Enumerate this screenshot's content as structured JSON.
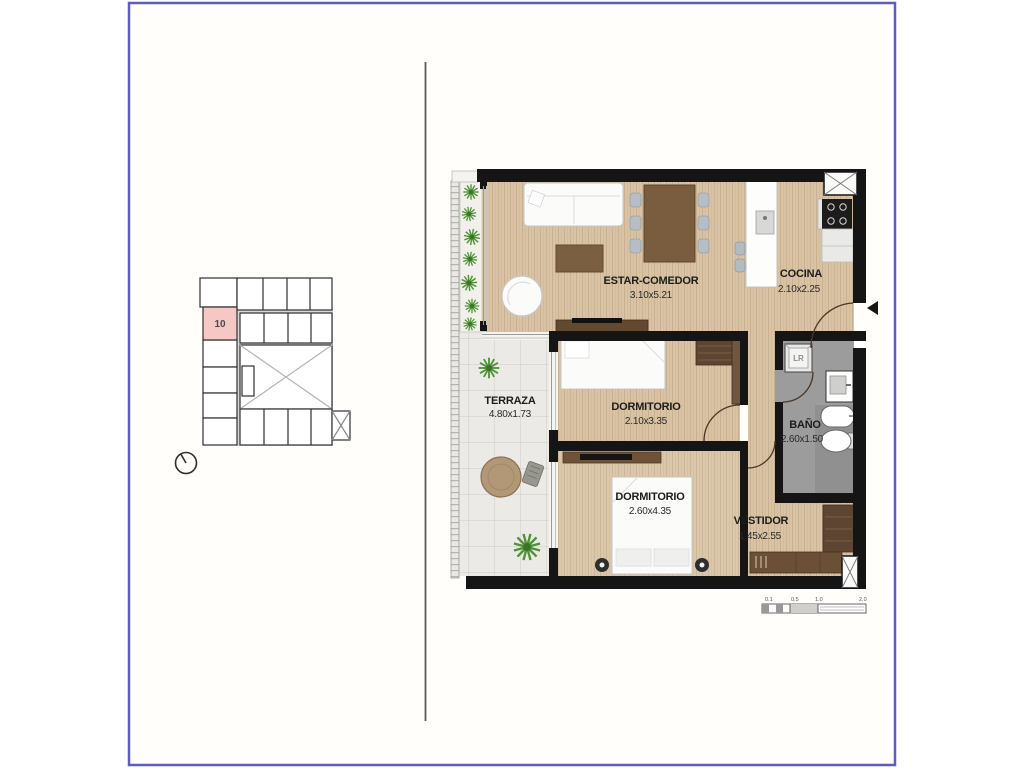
{
  "frame": {
    "border_color": "#5c5cc2"
  },
  "key_plan": {
    "unit_label": "10",
    "highlight_color": "#f5c8c5"
  },
  "rooms": {
    "estar_comedor": {
      "name": "ESTAR-COMEDOR",
      "dims": "3.10x5.21"
    },
    "cocina": {
      "name": "COCINA",
      "dims": "2.10x2.25"
    },
    "terraza": {
      "name": "TERRAZA",
      "dims": "4.80x1.73"
    },
    "dormitorio1": {
      "name": "DORMITORIO",
      "dims": "2.10x3.35"
    },
    "bano": {
      "name": "BAÑO",
      "dims": "2.60x1.50"
    },
    "dormitorio2": {
      "name": "DORMITORIO",
      "dims": "2.60x4.35"
    },
    "vestidor": {
      "name": "VESTIDOR",
      "dims": "1.45x2.55"
    }
  },
  "labels": {
    "laundry": "LR"
  },
  "scale_bar": {
    "ticks": [
      "0.1",
      "0.5",
      "1.0",
      "2.0"
    ]
  },
  "colors": {
    "wall": "#151515",
    "wood_floor": "#d9c3a4",
    "bath_floor": "#9c9c9c",
    "terrace_tile": "#eceae6",
    "highlight_pink": "#f5c8c5",
    "frame_blue": "#5c5cc2"
  }
}
